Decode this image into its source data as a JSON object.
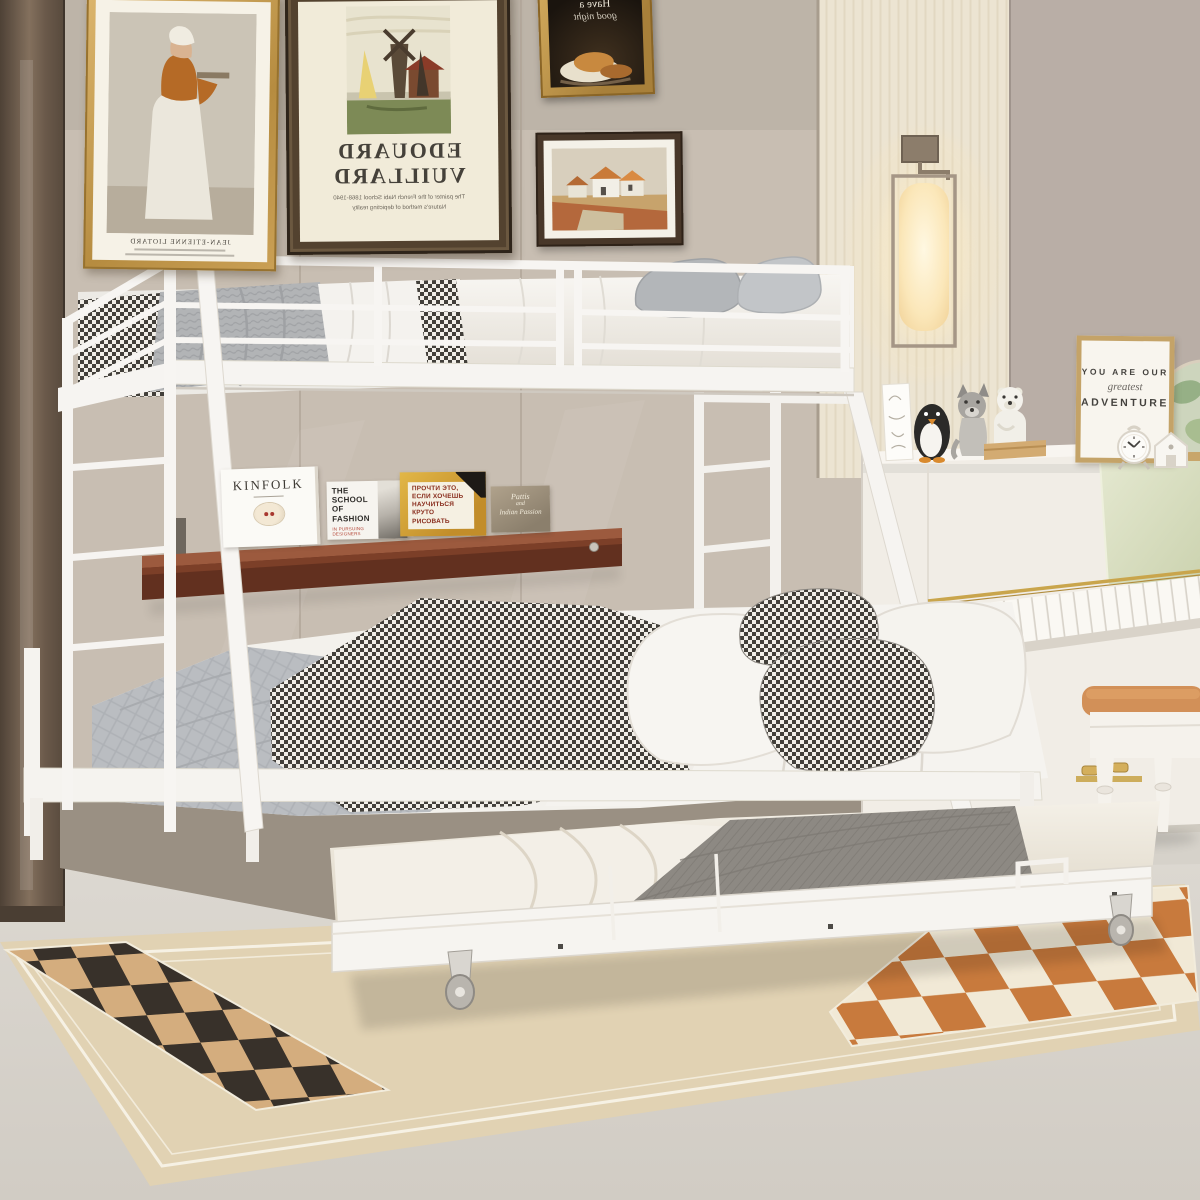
{
  "scene": {
    "objects": [
      "bunk-bed",
      "trundle-bed",
      "ladder",
      "guardrail",
      "wall-shelf",
      "books",
      "wall-sconce",
      "picture-frames",
      "upright-piano",
      "piano-bench",
      "checkered-rug",
      "animal-figurines",
      "alarm-clock",
      "globe",
      "wardrobe"
    ]
  },
  "wall_art": {
    "portrait_frame": {
      "caption": "JEAN-ETIENNE LIOTARD"
    },
    "windmill_poster": {
      "title_line1": "EDOUARD",
      "title_line2": "VUILLARD",
      "caption_line1": "The painter of the French Nabi School 1868-1940",
      "caption_line2": "Nature's method of depicting reality"
    },
    "still_life_frame": {
      "line1": "Have a",
      "line2": "good night"
    }
  },
  "shelf": {
    "books": [
      {
        "title": "KINFOLK"
      },
      {
        "title_line1": "THE SCHOOL",
        "title_line2": "OF FASHION",
        "subtitle": "IN PURSUING DESIGNERS"
      },
      {
        "lines": [
          "ПРОЧТИ ЭТО,",
          "ЕСЛИ ХОЧЕШЬ",
          "НАУЧИТЬСЯ",
          "КРУТО РИСОВАТЬ"
        ]
      },
      {
        "line1": "Pattis",
        "line2": "and",
        "line3": "Indian Passion"
      }
    ]
  },
  "decor_sign": {
    "line1": "YOU ARE OUR",
    "line2": "greatest",
    "line3": "ADVENTURE"
  },
  "palette": {
    "wall": "#c8beb2",
    "wall_right": "#b9aea6",
    "wallpaper": "#ece4d2",
    "wardrobe": "#6b5a4a",
    "floor": "#d9d5ce",
    "rug_base": "#dfcfae",
    "rug_check_dark": "#38312a",
    "rug_check_tan": "#d4ad7e",
    "rug_check_orange": "#c87a3d",
    "bed_frame": "#f6f4f1",
    "shelf_wood": "#6b3222",
    "bench_cushion": "#cf9158",
    "piano": "#f1ede6",
    "gold_trim": "#c9a54c",
    "sign_frame": "#c4a368"
  }
}
